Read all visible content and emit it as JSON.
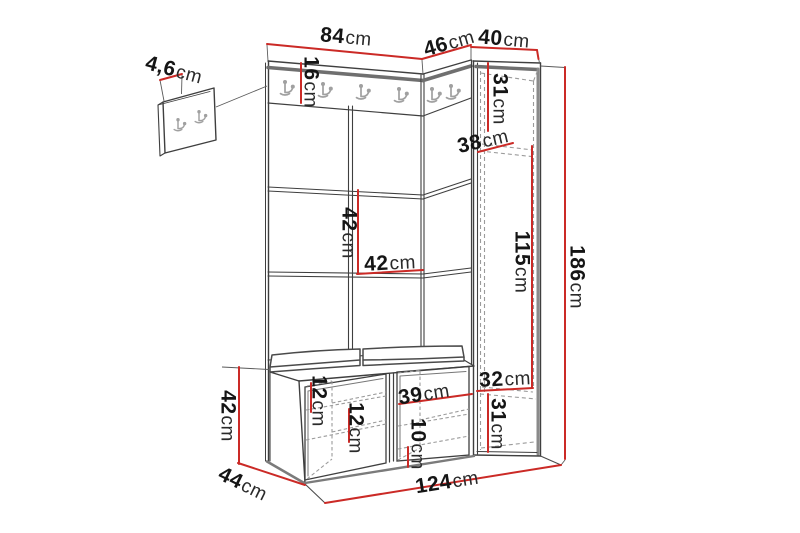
{
  "page": {
    "background": "#ffffff"
  },
  "colors": {
    "dimension_line": "#cb2a26",
    "outline": "#3f3f3f",
    "thick_edge": "#6f6f6f",
    "dashed_line": "#9b9b9b",
    "hook": "#a0a0a0",
    "label_text": "#151515"
  },
  "dims": {
    "detail_panel_thickness": {
      "value": "4,6",
      "unit": "cm"
    },
    "panel_width": {
      "value": "84",
      "unit": "cm"
    },
    "corner_width": {
      "value": "46",
      "unit": "cm"
    },
    "cabinet_width": {
      "value": "40",
      "unit": "cm"
    },
    "hook_strip_height": {
      "value": "16",
      "unit": "cm"
    },
    "cabinet_top_section": {
      "value": "31",
      "unit": "cm"
    },
    "cabinet_depth": {
      "value": "38",
      "unit": "cm"
    },
    "panel_module_height": {
      "value": "42",
      "unit": "cm"
    },
    "panel_module_width": {
      "value": "42",
      "unit": "cm"
    },
    "cabinet_middle_section": {
      "value": "115",
      "unit": "cm"
    },
    "total_height": {
      "value": "186",
      "unit": "cm"
    },
    "bench_height": {
      "value": "42",
      "unit": "cm"
    },
    "bench_depth": {
      "value": "44",
      "unit": "cm"
    },
    "bench_shelf_gap_a": {
      "value": "12",
      "unit": "cm"
    },
    "bench_shelf_gap_b": {
      "value": "12",
      "unit": "cm"
    },
    "bench_cubby_width": {
      "value": "39",
      "unit": "cm"
    },
    "bench_cubby_gap": {
      "value": "10",
      "unit": "cm"
    },
    "cabinet_inner_width": {
      "value": "32",
      "unit": "cm"
    },
    "cabinet_bottom_section": {
      "value": "31",
      "unit": "cm"
    },
    "total_width": {
      "value": "124",
      "unit": "cm"
    }
  }
}
